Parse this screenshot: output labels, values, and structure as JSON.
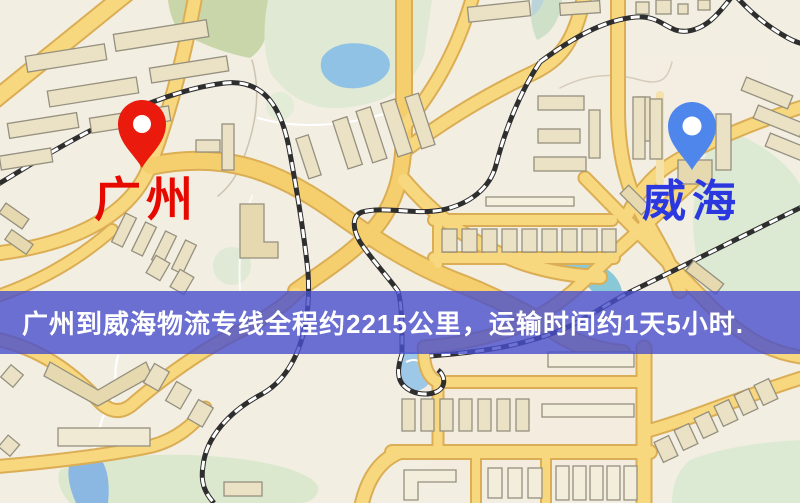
{
  "banner": {
    "text": "广州到威海物流专线全程约2215公里，运输时间约1天5小时.",
    "distance_text": "约2215公里",
    "duration_text": "约1天5小时",
    "background_color": "#494fcd",
    "text_color": "#ffffff"
  },
  "markers": {
    "origin": {
      "label": "广州",
      "pin_color": "#ea1b0d",
      "label_color": "#e60900"
    },
    "destination": {
      "label": "威海",
      "pin_color": "#4f86ec",
      "label_color": "#2b38df"
    }
  },
  "map": {
    "colors": {
      "background": "#f2eee2",
      "road_fill": "#f9d87c",
      "road_casing": "#dcae52",
      "railway": "#2e2e2e",
      "green_area": "#dce8cc",
      "water": "#8fc2e6",
      "building_fill": "#ebe2c4",
      "building_stroke": "#95907e"
    }
  }
}
